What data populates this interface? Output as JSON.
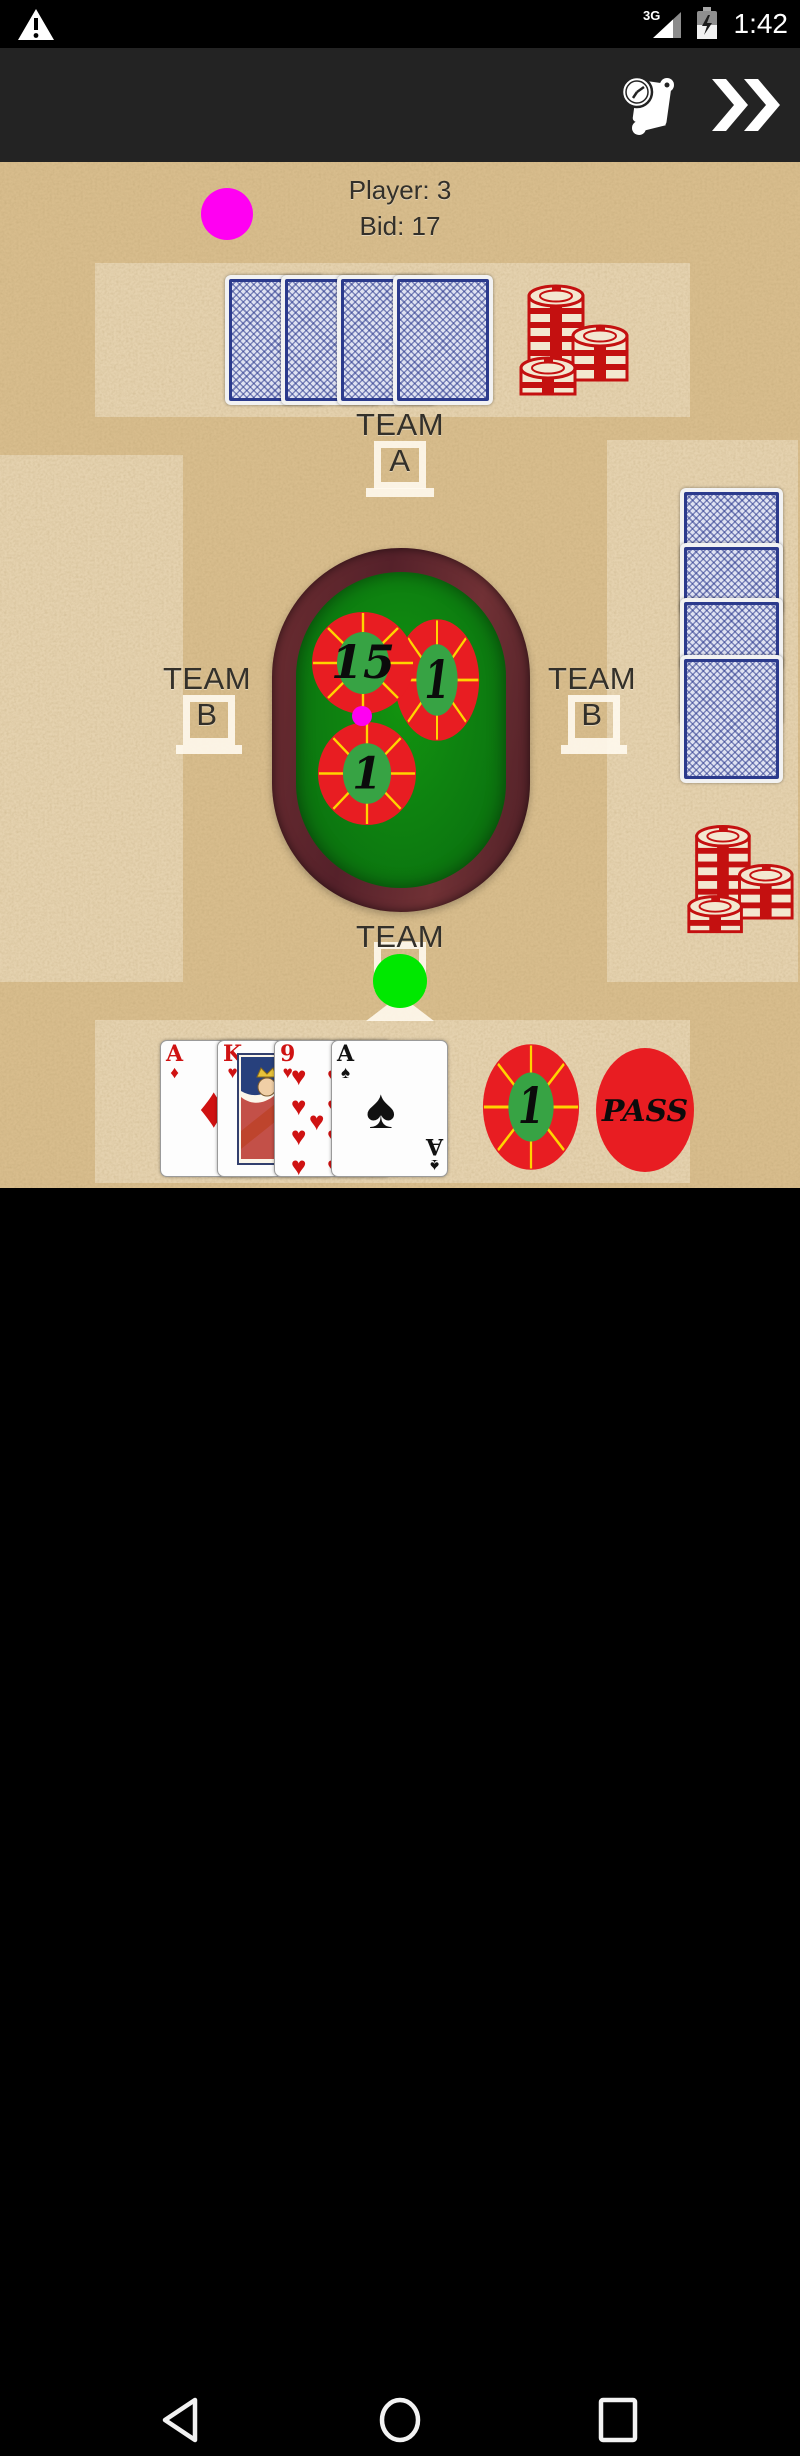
{
  "status_bar": {
    "network_label": "3G",
    "time": "1:42"
  },
  "icons": {
    "status_warning": "warning-triangle-icon",
    "status_signal": "cell-signal-icon",
    "status_battery": "battery-charging-icon",
    "action_history": "score-scroll-clock-icon",
    "action_skip": "double-chevron-right-icon",
    "nav_back": "back-triangle-icon",
    "nav_home": "home-circle-icon",
    "nav_recents": "recents-square-icon"
  },
  "header": {
    "player_line": "Player: 3",
    "bid_line": "Bid: 17"
  },
  "teams": {
    "top": {
      "name": "TEAM",
      "letter": "A"
    },
    "left": {
      "name": "TEAM",
      "letter": "B"
    },
    "right": {
      "name": "TEAM",
      "letter": "B"
    },
    "bottom": {
      "name": "TEAM"
    }
  },
  "pots": [
    {
      "value": "15"
    },
    {
      "value": "1"
    },
    {
      "value": "1"
    }
  ],
  "bidding": {
    "chip_value": "1",
    "pass_label": "PASS"
  },
  "player_hand": [
    {
      "rank": "A",
      "suit": "♦"
    },
    {
      "rank": "K",
      "suit": "♥"
    },
    {
      "rank": "9",
      "suit": "♥"
    },
    {
      "rank": "A",
      "suit": "♠"
    }
  ],
  "opponents": {
    "top_facedown_cards": 4,
    "right_facedown_cards": 4
  },
  "colors": {
    "accent_magenta": "#ff00f2",
    "turn_green": "#00e800",
    "chip_red": "#e81d22",
    "chip_spoke_yellow": "#ffd400",
    "chip_center_green": "#37a344",
    "felt_green": "#0d7d10",
    "table_wood": "#5d2429",
    "card_back_blue": "#2b3a8c",
    "paper_tan": "#d8bd8d"
  }
}
